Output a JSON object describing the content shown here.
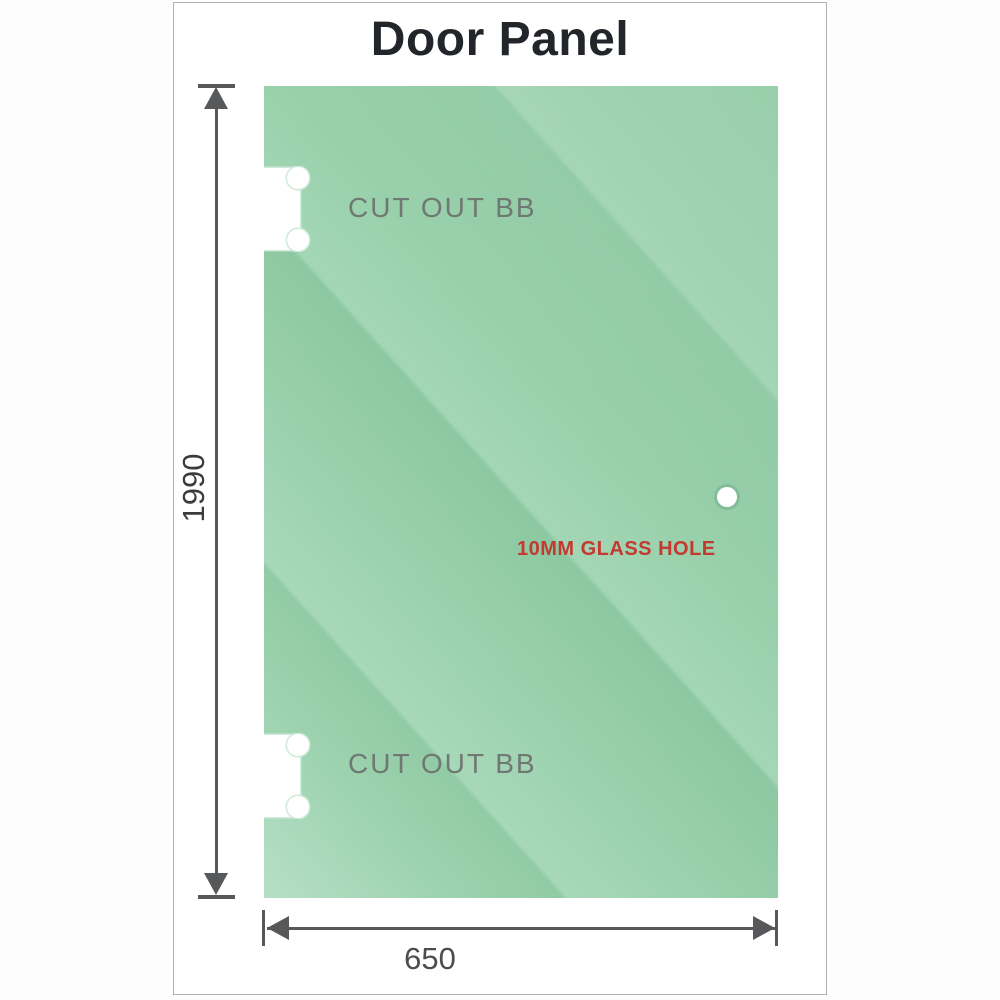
{
  "title": "Door Panel",
  "panel": {
    "cutout_top_label": "CUT OUT BB",
    "cutout_bottom_label": "CUT OUT BB",
    "hole_label": "10MM GLASS HOLE"
  },
  "dimensions": {
    "height_value": "1990",
    "width_value": "650"
  },
  "colors": {
    "glass_base": "#93cca7",
    "glass_highlight": "#b6dfc5",
    "glass_shadow": "#81c397",
    "dimension_line": "#57585a",
    "hole_label_red": "#c33a31",
    "cutout_label_gray": "#6f7873",
    "frame_border": "#b2b2b2",
    "title_color": "#22252a"
  }
}
